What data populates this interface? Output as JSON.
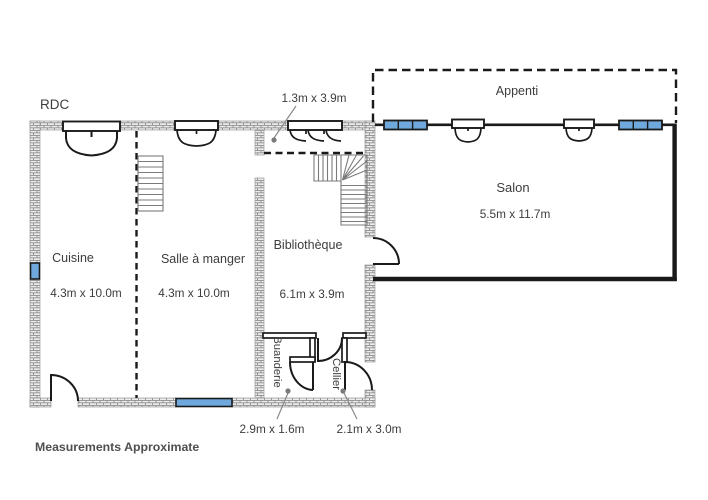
{
  "plan": {
    "floor_label": "RDC",
    "footer": "Measurements Approximate",
    "rooms": [
      {
        "name": "Cuisine",
        "dimensions": "4.3m x 10.0m"
      },
      {
        "name": "Salle à manger",
        "dimensions": "4.3m x 10.0m"
      },
      {
        "name": "Bibliothèque",
        "dimensions": "6.1m x 3.9m"
      },
      {
        "name": "Salon",
        "dimensions": "5.5m x 11.7m"
      },
      {
        "name": "Appenti",
        "dimensions": ""
      },
      {
        "name": "Buanderie",
        "dimensions": "2.9m x 1.6m"
      },
      {
        "name": "Cellier",
        "dimensions": "2.1m x 3.0m"
      }
    ],
    "annotations": {
      "vestibule_dimensions": "1.3m x 3.9m"
    },
    "colors": {
      "window_blue": "#6fa8dc",
      "wall_dark": "#1a1a1a",
      "hatch_gray": "#8f8f8f",
      "text_gray": "#3d3d3d"
    }
  }
}
